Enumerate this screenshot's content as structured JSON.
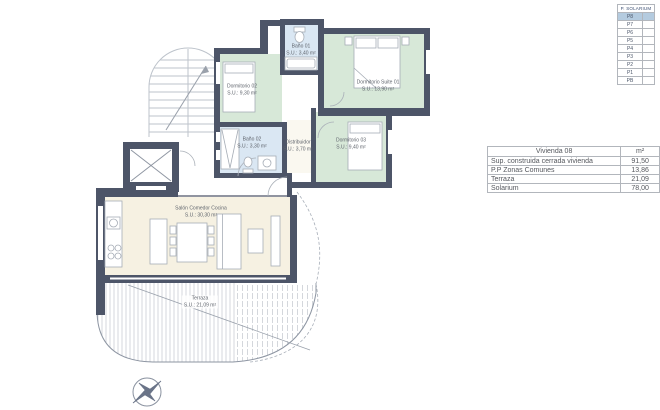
{
  "legend": {
    "title": "P. SOLARIUM",
    "items": [
      "P8",
      "P7",
      "P6",
      "P5",
      "P4",
      "P3",
      "P2",
      "P1",
      "PB"
    ],
    "highlighted_item": "P8"
  },
  "area_table": {
    "title": "Vivienda 08",
    "unit_header": "m²",
    "rows": [
      {
        "concept": "Sup. construida cerrada vivienda",
        "value": "91,50"
      },
      {
        "concept": "P.P Zonas Comunes",
        "value": "13,86"
      },
      {
        "concept": "Terraza",
        "value": "21,09"
      },
      {
        "concept": "Solarium",
        "value": "78,00"
      }
    ]
  },
  "plan": {
    "rooms": {
      "dormitorio_02": {
        "name": "Dormitorio 02",
        "area": "S.U.: 9,30 m²"
      },
      "bano_01": {
        "name": "Baño 01",
        "area": "S.U.: 3,40 m²"
      },
      "dormitorio_suite_01": {
        "name": "Dormitorio Suite 01",
        "area": "S.U.: 13,90 m²"
      },
      "bano_02": {
        "name": "Baño 02",
        "area": "S.U.: 3,30 m²"
      },
      "distribuidor": {
        "name": "Distribuidor",
        "area": "S.U.: 3,70 m²"
      },
      "dormitorio_03": {
        "name": "Dormitorio 03",
        "area": "S.U.: 9,40 m²"
      },
      "salon": {
        "name": "Salón Comedor Cocina",
        "area": "S.U.: 30,30 m²"
      },
      "terraza": {
        "name": "Terraza",
        "area": "S.U.: 21,09 m²"
      }
    }
  },
  "colors": {
    "wall": "#4d5568",
    "bedroom_fill": "#d7e8d8",
    "bathroom_fill": "#dae7f3",
    "living_fill": "#f6f1e2",
    "distributor_fill": "#faf8f0",
    "legend_highlight": "#b4cbdf"
  }
}
